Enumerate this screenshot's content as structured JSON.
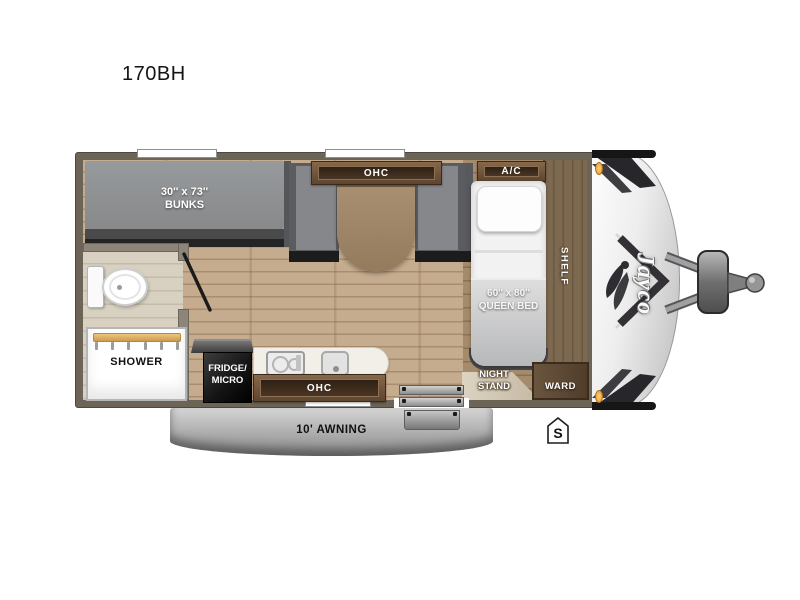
{
  "title": "170BH",
  "brand": "Jayco",
  "rooms": {
    "bunks": {
      "size": "30'' x 73''",
      "name": "BUNKS"
    },
    "dinette_ohc": "OHC",
    "ac": "A/C",
    "queen_bed": {
      "size": "60'' x 80''",
      "name": "QUEEN BED"
    },
    "shelf": "SHELF",
    "night_stand_line1": "NIGHT",
    "night_stand_line2": "STAND",
    "ward": "WARD",
    "shower": "SHOWER",
    "fridge_line1": "FRIDGE/",
    "fridge_line2": "MICRO",
    "kitchen_ohc": "OHC",
    "awning": "10' AWNING",
    "spare_tire": "S"
  },
  "colors": {
    "wall": "#6b6457",
    "floor": "#c6ac8e",
    "cabinet_inner": "#2f2115",
    "bench": "#85878b",
    "mattress_gray": "#8f9193",
    "accent_light": "#e8952d"
  }
}
